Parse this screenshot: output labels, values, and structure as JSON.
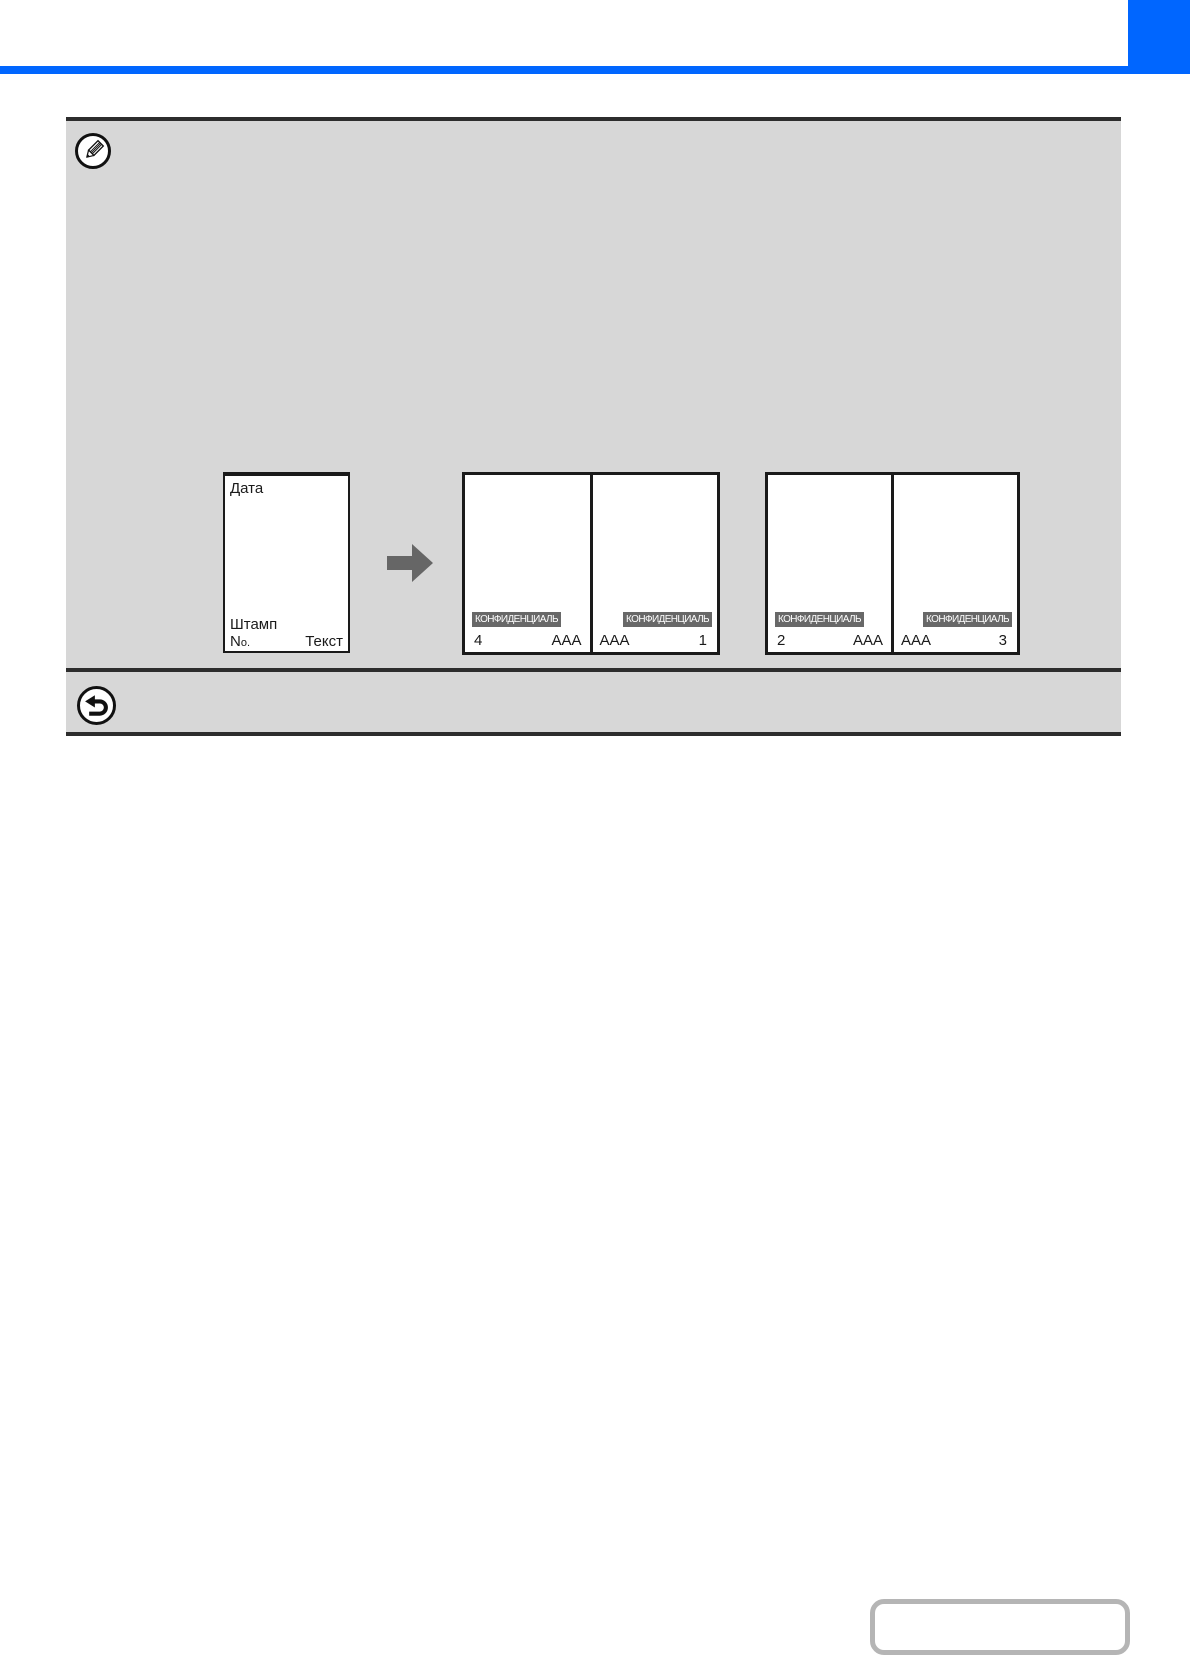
{
  "colors": {
    "accent_blue": "#0066ff",
    "panel_gray": "#d7d7d7",
    "dark_border": "#2d2d2d",
    "page_border": "#1a1a1a",
    "stamp_bg": "#686868",
    "arrow_gray": "#666666",
    "link_box_border": "#b5b5b5"
  },
  "header": {
    "corner_block_icon": "chapter-corner-marker",
    "rule_icon": "blue-divider-rule"
  },
  "note_panel": {
    "icon": "pencil-note-icon",
    "diagram": {
      "original": {
        "date_label": "Дата",
        "stamp_label": "Штамп",
        "number_label_n": "N",
        "number_label_o": "o.",
        "text_label": "Текст"
      },
      "arrow_icon": "right-arrow-icon",
      "spreads": [
        {
          "pages": [
            {
              "stamp": "КОНФИДЕНЦИАЛЬ",
              "number": "4",
              "text": "AAA"
            },
            {
              "stamp": "КОНФИДЕНЦИАЛЬ",
              "number": "1",
              "text": "AAA"
            }
          ]
        },
        {
          "pages": [
            {
              "stamp": "КОНФИДЕНЦИАЛЬ",
              "number": "2",
              "text": "AAA"
            },
            {
              "stamp": "КОНФИДЕНЦИАЛЬ",
              "number": "3",
              "text": "AAA"
            }
          ]
        }
      ]
    }
  },
  "footer_bar": {
    "icon": "return-back-icon"
  },
  "link_box": {
    "label": ""
  }
}
